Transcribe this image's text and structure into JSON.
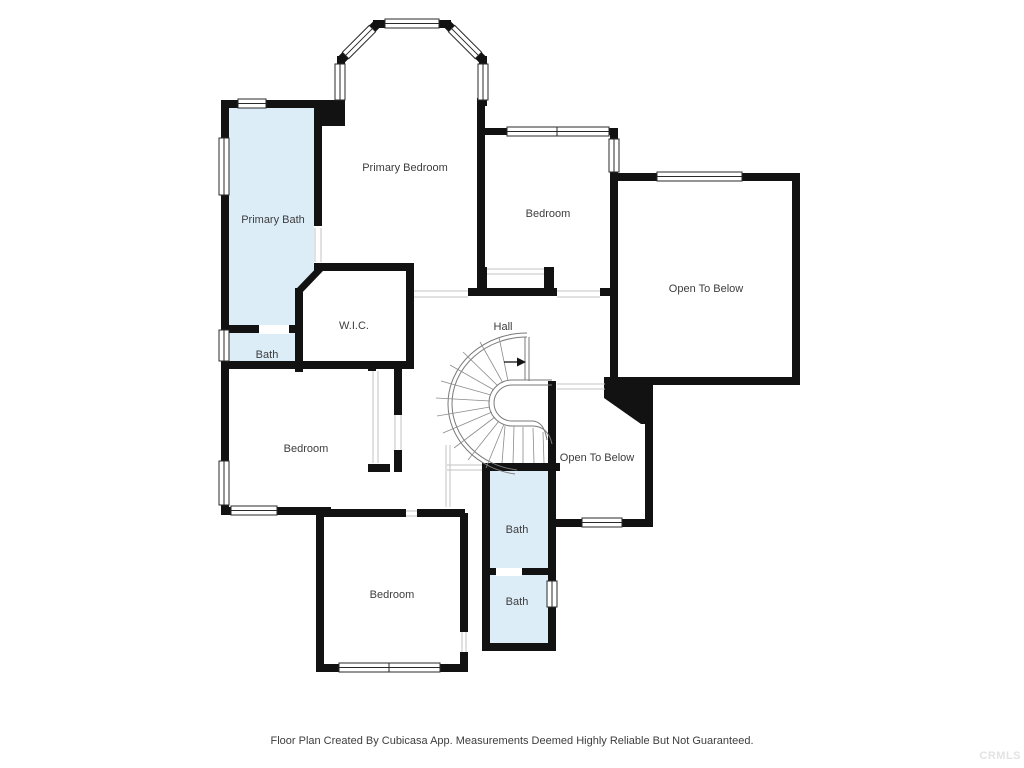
{
  "rooms": {
    "primary_bedroom": {
      "label": "Primary Bedroom"
    },
    "primary_bath": {
      "label": "Primary Bath"
    },
    "bedroom_top_right": {
      "label": "Bedroom"
    },
    "open_to_below_top": {
      "label": "Open To Below"
    },
    "wic": {
      "label": "W.I.C."
    },
    "hall": {
      "label": "Hall"
    },
    "bath_left": {
      "label": "Bath"
    },
    "bedroom_mid_left": {
      "label": "Bedroom"
    },
    "open_to_below_mid": {
      "label": "Open To Below"
    },
    "bath_mid": {
      "label": "Bath"
    },
    "bath_lower": {
      "label": "Bath"
    },
    "bedroom_bottom": {
      "label": "Bedroom"
    }
  },
  "footer": {
    "text": "Floor Plan Created By Cubicasa App. Measurements Deemed Highly Reliable But Not Guaranteed."
  },
  "watermark": {
    "text": "CRMLS"
  },
  "colors": {
    "wall": "#121212",
    "bath_fill": "#ddedf8",
    "label": "#3d3d3d",
    "watermark": "#e3e3e3"
  }
}
